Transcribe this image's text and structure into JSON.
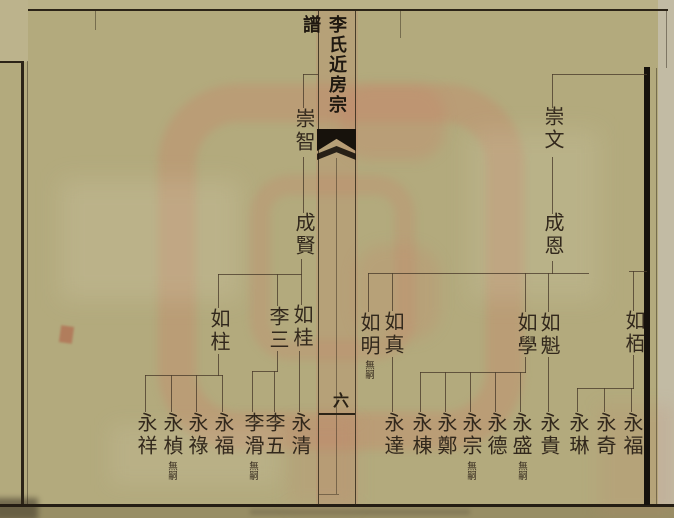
{
  "colors": {
    "paper": "#b3aa7d",
    "ink": "#32281c",
    "frame_ink": "#2c2417",
    "black_bar": "#16120d",
    "stain_pink": "#c98f78"
  },
  "fold": {
    "title": "李氏近房宗譜",
    "page_number": "六"
  },
  "right_page": {
    "ancestor": "崇文",
    "second_generation": "成恩",
    "children": [
      {
        "name": "如栢",
        "note": ""
      },
      {
        "name": "如魁",
        "note": ""
      },
      {
        "name": "如學",
        "note": ""
      },
      {
        "name": "如真",
        "note": ""
      },
      {
        "name": "如明",
        "note": "無嗣"
      }
    ],
    "grandchildren": [
      {
        "name": "永福",
        "note": ""
      },
      {
        "name": "永奇",
        "note": ""
      },
      {
        "name": "永琳",
        "note": ""
      },
      {
        "name": "永貴",
        "note": ""
      },
      {
        "name": "永盛",
        "note": "無嗣"
      },
      {
        "name": "永德",
        "note": ""
      },
      {
        "name": "永宗",
        "note": "無嗣"
      },
      {
        "name": "永鄭",
        "note": ""
      },
      {
        "name": "永棟",
        "note": ""
      },
      {
        "name": "永達",
        "note": ""
      }
    ]
  },
  "left_page": {
    "ancestor": "崇智",
    "second_generation": "成賢",
    "children": [
      {
        "name": "如桂",
        "note": ""
      },
      {
        "name": "李三",
        "note": ""
      },
      {
        "name": "如柱",
        "note": ""
      }
    ],
    "grandchildren": [
      {
        "name": "永清",
        "note": ""
      },
      {
        "name": "李五",
        "note": ""
      },
      {
        "name": "李滑",
        "note": "無嗣"
      },
      {
        "name": "永福",
        "note": ""
      },
      {
        "name": "永祿",
        "note": ""
      },
      {
        "name": "永楨",
        "note": "無嗣"
      },
      {
        "name": "永祥",
        "note": ""
      }
    ]
  }
}
